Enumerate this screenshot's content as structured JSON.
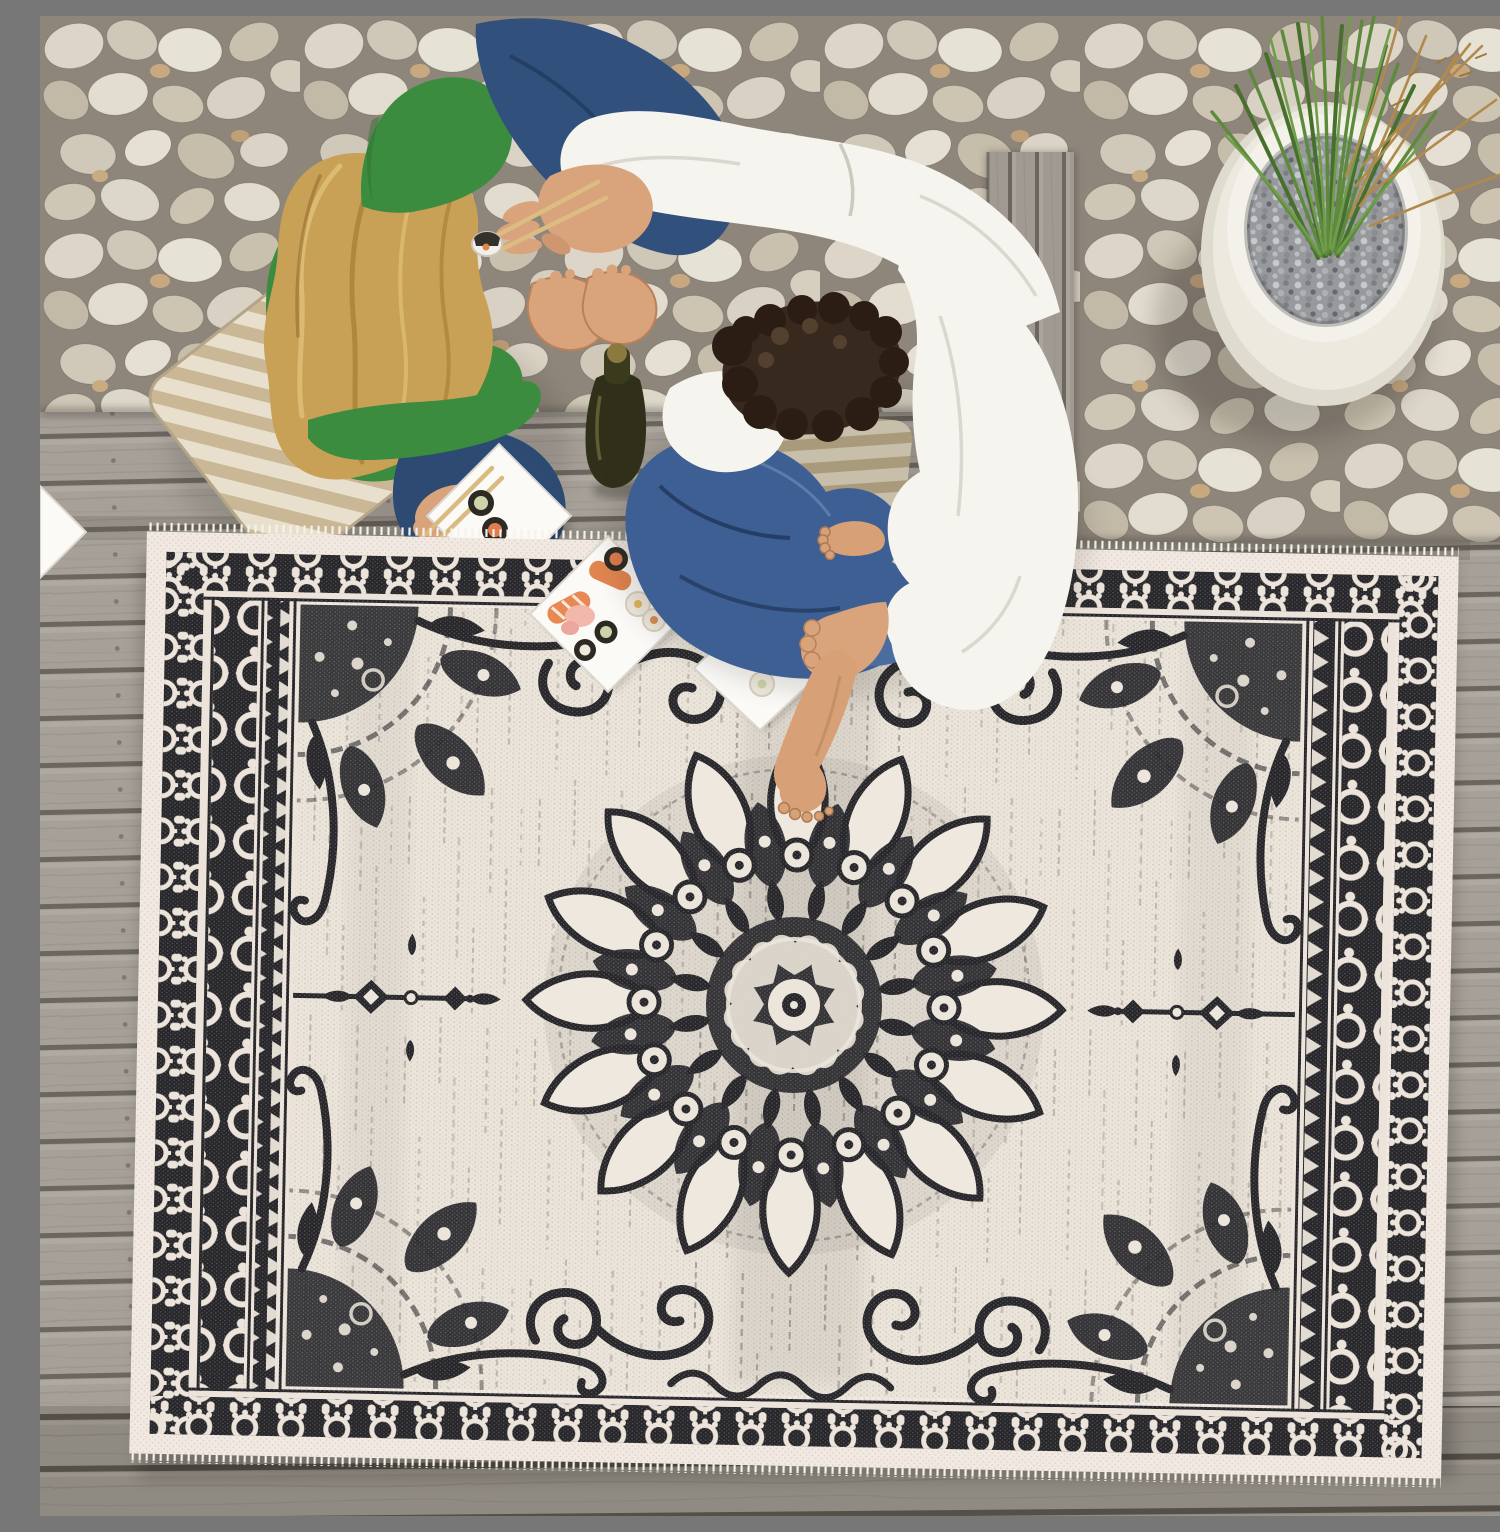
{
  "scene": {
    "type": "product-photo",
    "camera": "top-down overhead",
    "alt": "Overhead view of a couple sharing sushi on a weathered gray wooden deck. A woman in a green long-sleeve top with long blonde hair sits cross-legged on a striped cream cushion facing a man in a white shirt and blue jeans with dark curly hair. White square plates of sushi, chopsticks and a beer bottle sit between them. The top of the frame is a bed of white river pebbles with a round white planter of tall green grass. A large black-and-cream distressed oriental medallion outdoor rug covers the lower two thirds of the deck.",
    "setting": "outdoor patio deck with pebble border"
  },
  "palette": {
    "deck": "#a6a098",
    "deck_gap": "#6b665f",
    "deck_dark": "#918b83",
    "pebble_bg": "#8f867b",
    "stone_light": "#e7e2d6",
    "stone_mid": "#cfc7b7",
    "stone_tan": "#c8a87e",
    "pot_white": "#eceade",
    "gravel": "#97999c",
    "grass_green": "#5d8a3c",
    "grass_dark": "#47702d",
    "dried_grass": "#b08a4d",
    "hair_blonde": "#c9a156",
    "skin": "#d9a37c",
    "sweater_green": "#3c8c40",
    "jeans_her": "#31517c",
    "jeans_his": "#3d5f93",
    "shirt_white": "#f6f4ef",
    "bottle_olive": "#30301a",
    "plate_white": "#fbfaf7",
    "salmon": "#e2854f",
    "ginger_pink": "#f2b8ac",
    "nori": "#2c2a22",
    "rice": "#efe9dc",
    "rug_cream": "#ece5db",
    "rug_margin": "#f2eae2",
    "rug_black": "#26262a",
    "chopstick": "#d9ba80"
  },
  "objects": {
    "pebble_bed": {
      "position": "top band and upper right",
      "stones": "white and tan river pebbles"
    },
    "planter": {
      "position": "upper right on pebbles",
      "shape": "round white pot",
      "fill": "gray gravel",
      "plant": "tall green ornamental grass with dried blades"
    },
    "deck": {
      "material": "weathered gray wood planks",
      "orientation": "horizontal boards"
    },
    "woman": {
      "position": "upper left",
      "hair": "long blonde",
      "top": "green long-sleeve",
      "bottom": "dark jeans",
      "barefoot": true,
      "seat": "striped cream floor cushion"
    },
    "man": {
      "position": "upper center-right",
      "hair": "dark curly",
      "top": "white long-sleeve shirt",
      "bottom": "blue jeans",
      "barefoot": true,
      "action": "holding chopsticks with a sushi piece toward the woman, other hand on his ankle"
    },
    "beer_bottle": {
      "count": 1,
      "color": "dark olive glass",
      "position": "center deck between the couple"
    },
    "sushi_plates": [
      {
        "location": "deck near woman",
        "items": "three maki rolls with chopsticks resting across"
      },
      {
        "location": "straddling rug top edge",
        "items": "salmon nigiri, shrimp, maki rolls, white rolls, pickled ginger"
      },
      {
        "location": "on rug",
        "items": "two sushi pieces"
      },
      {
        "location": "left image edge",
        "items": "corner of a white plate"
      }
    ],
    "rug": {
      "style": "distressed oriental medallion / mandala flatweave",
      "colors": [
        "black",
        "cream"
      ],
      "borders": [
        "outer pale dotted margin with short fringe",
        "black scalloped palmette band on all sides",
        "circle-chain guard stripe on long sides",
        "triangle zigzag guard stripe on long sides"
      ],
      "motifs": [
        "large 16-petal center mandala",
        "quarter mandala in each field corner",
        "pendant and diamond finials on the horizontal axis",
        "S-scroll cloud motifs near top and bottom",
        "corner swoop arches"
      ],
      "texture": "vertical stitched streaks across a cream field",
      "coverage": "lower two thirds of frame, slightly rotated clockwise"
    }
  }
}
